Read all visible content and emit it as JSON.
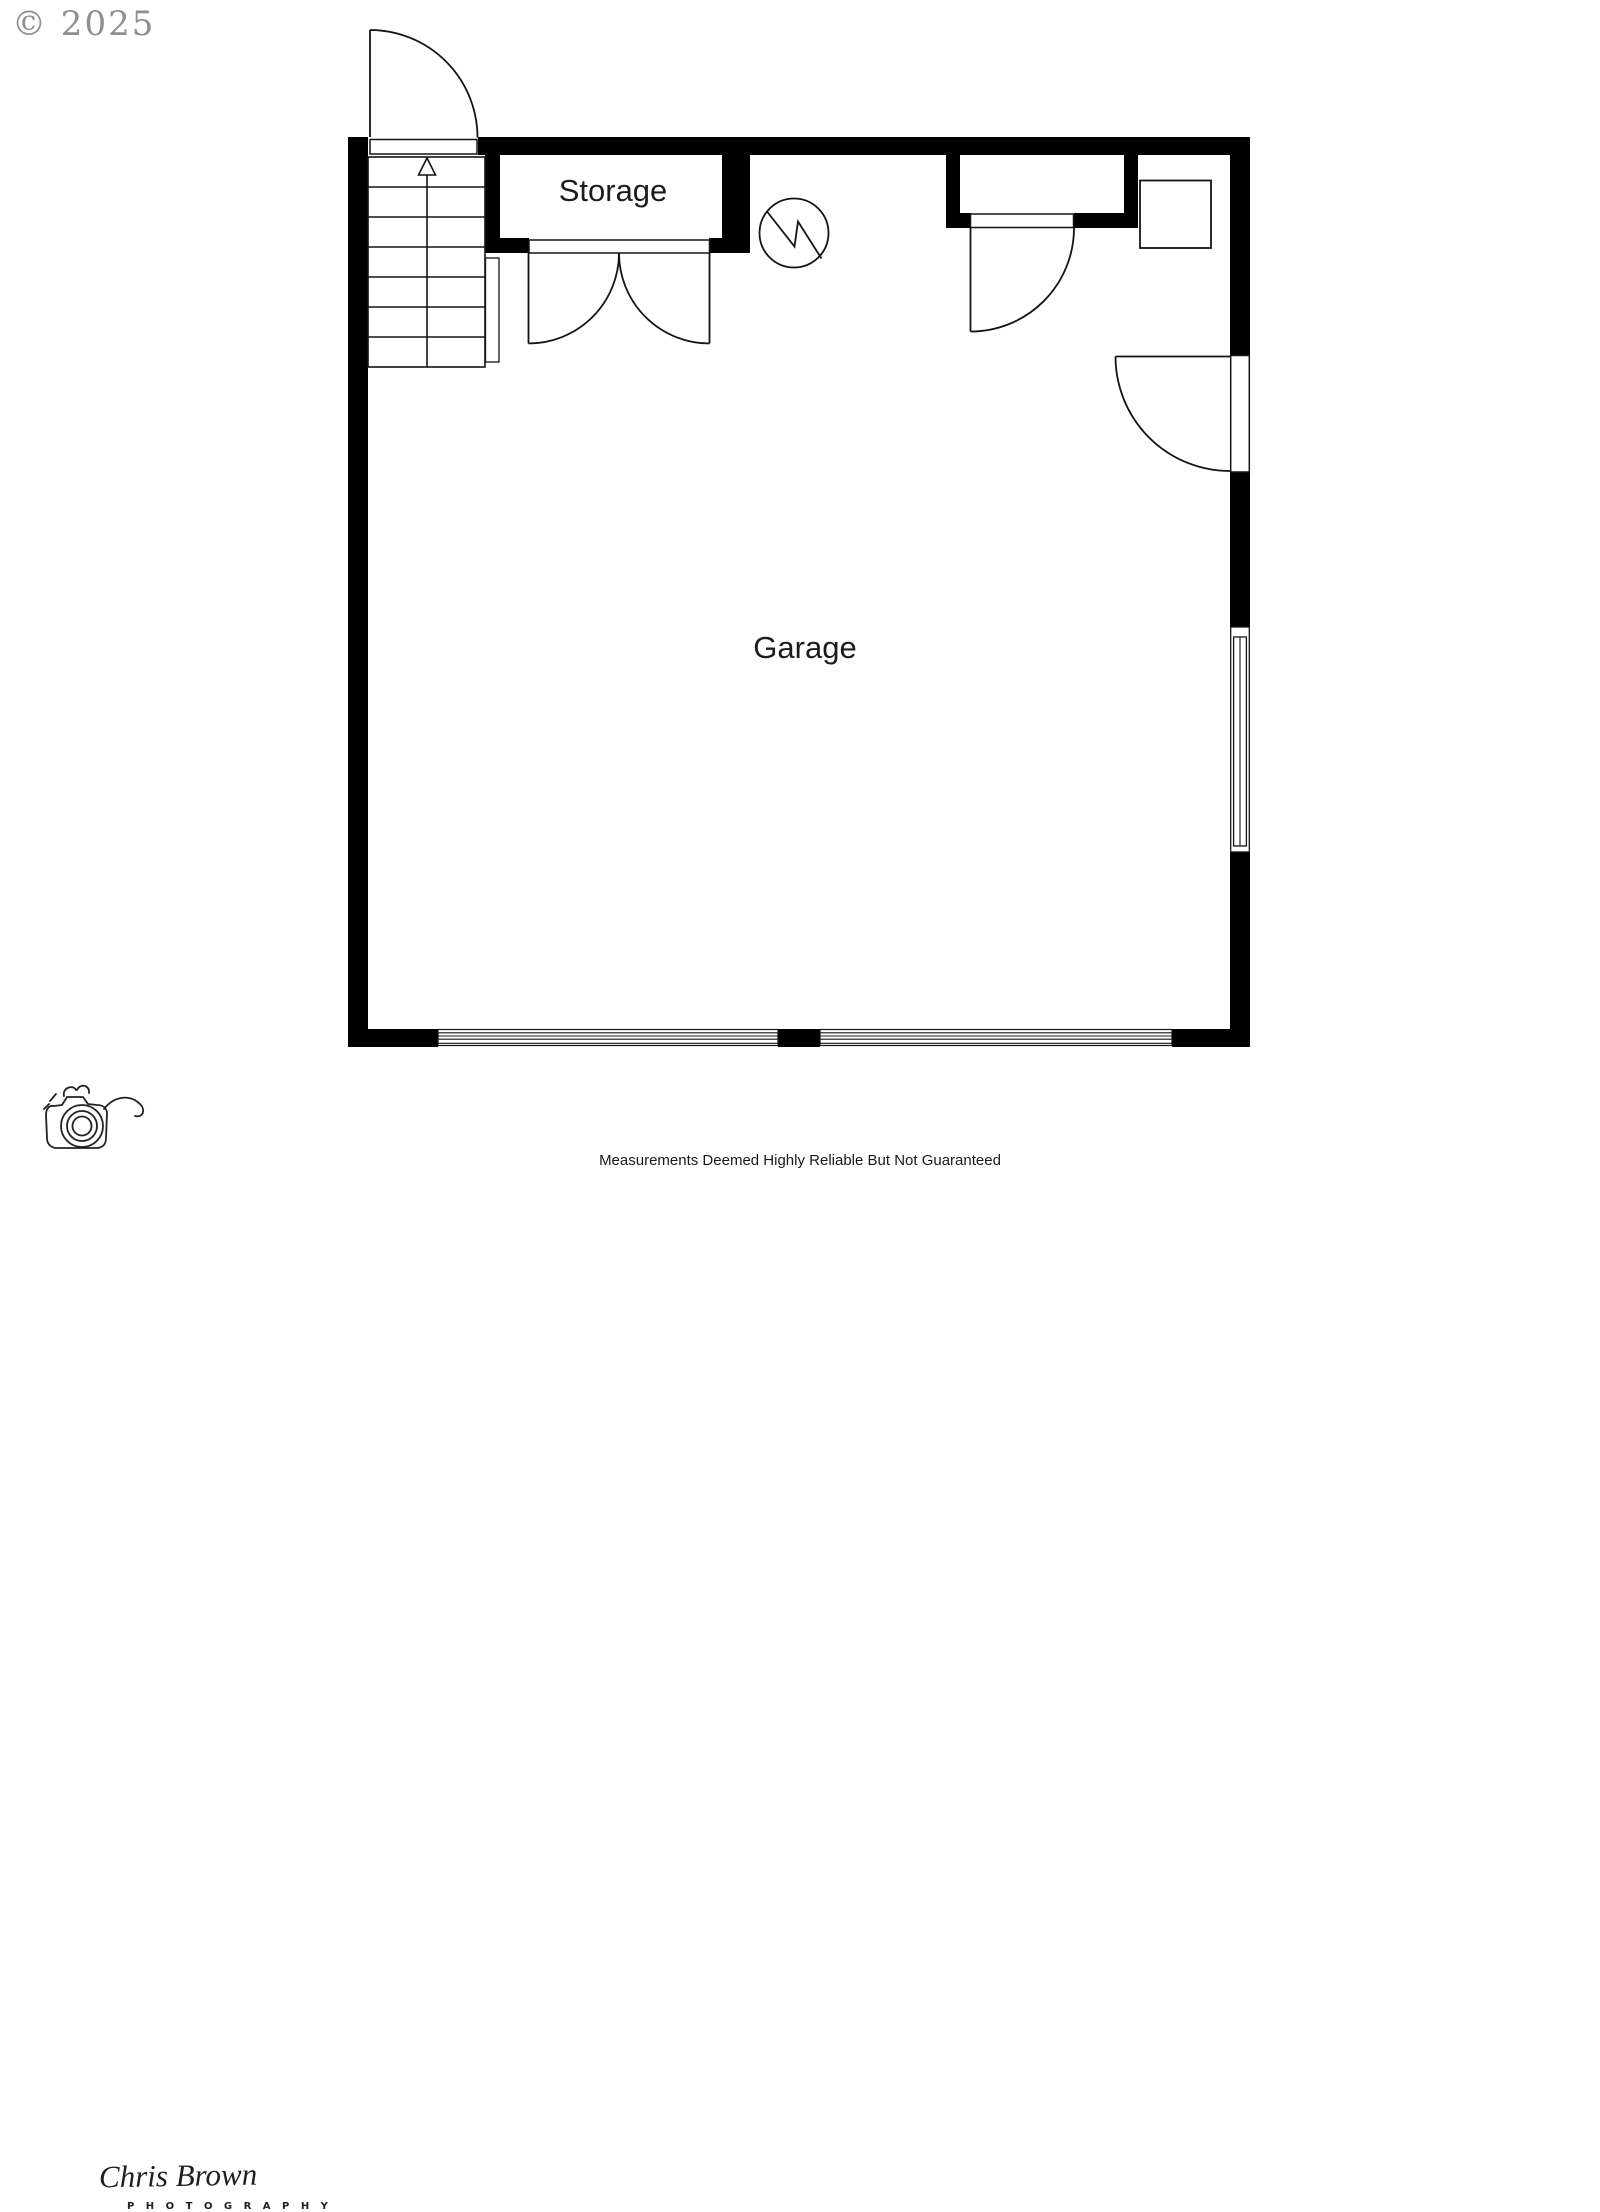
{
  "page": {
    "background": "#ffffff"
  },
  "copyright": {
    "text": "© 2025",
    "color": "#8f8f8f"
  },
  "floorplan": {
    "wall_color": "#000000",
    "line_color": "#141414",
    "rooms": [
      {
        "name": "storage",
        "label": "Storage"
      },
      {
        "name": "garage",
        "label": "Garage"
      }
    ],
    "symbols": [
      {
        "name": "staircase-up-arrow"
      },
      {
        "name": "entry-door-swing-top"
      },
      {
        "name": "storage-double-door"
      },
      {
        "name": "utility-circle-symbol"
      },
      {
        "name": "closet-door-swing"
      },
      {
        "name": "water-heater-square"
      },
      {
        "name": "side-entry-door-swing"
      },
      {
        "name": "window-right-wall"
      },
      {
        "name": "garage-door-left"
      },
      {
        "name": "garage-door-right"
      }
    ]
  },
  "watermark": {
    "name": "Chris Brown",
    "subtitle": "P H O T O G R A P H Y"
  },
  "footer": {
    "disclaimer": "Measurements Deemed Highly Reliable But Not Guaranteed"
  }
}
